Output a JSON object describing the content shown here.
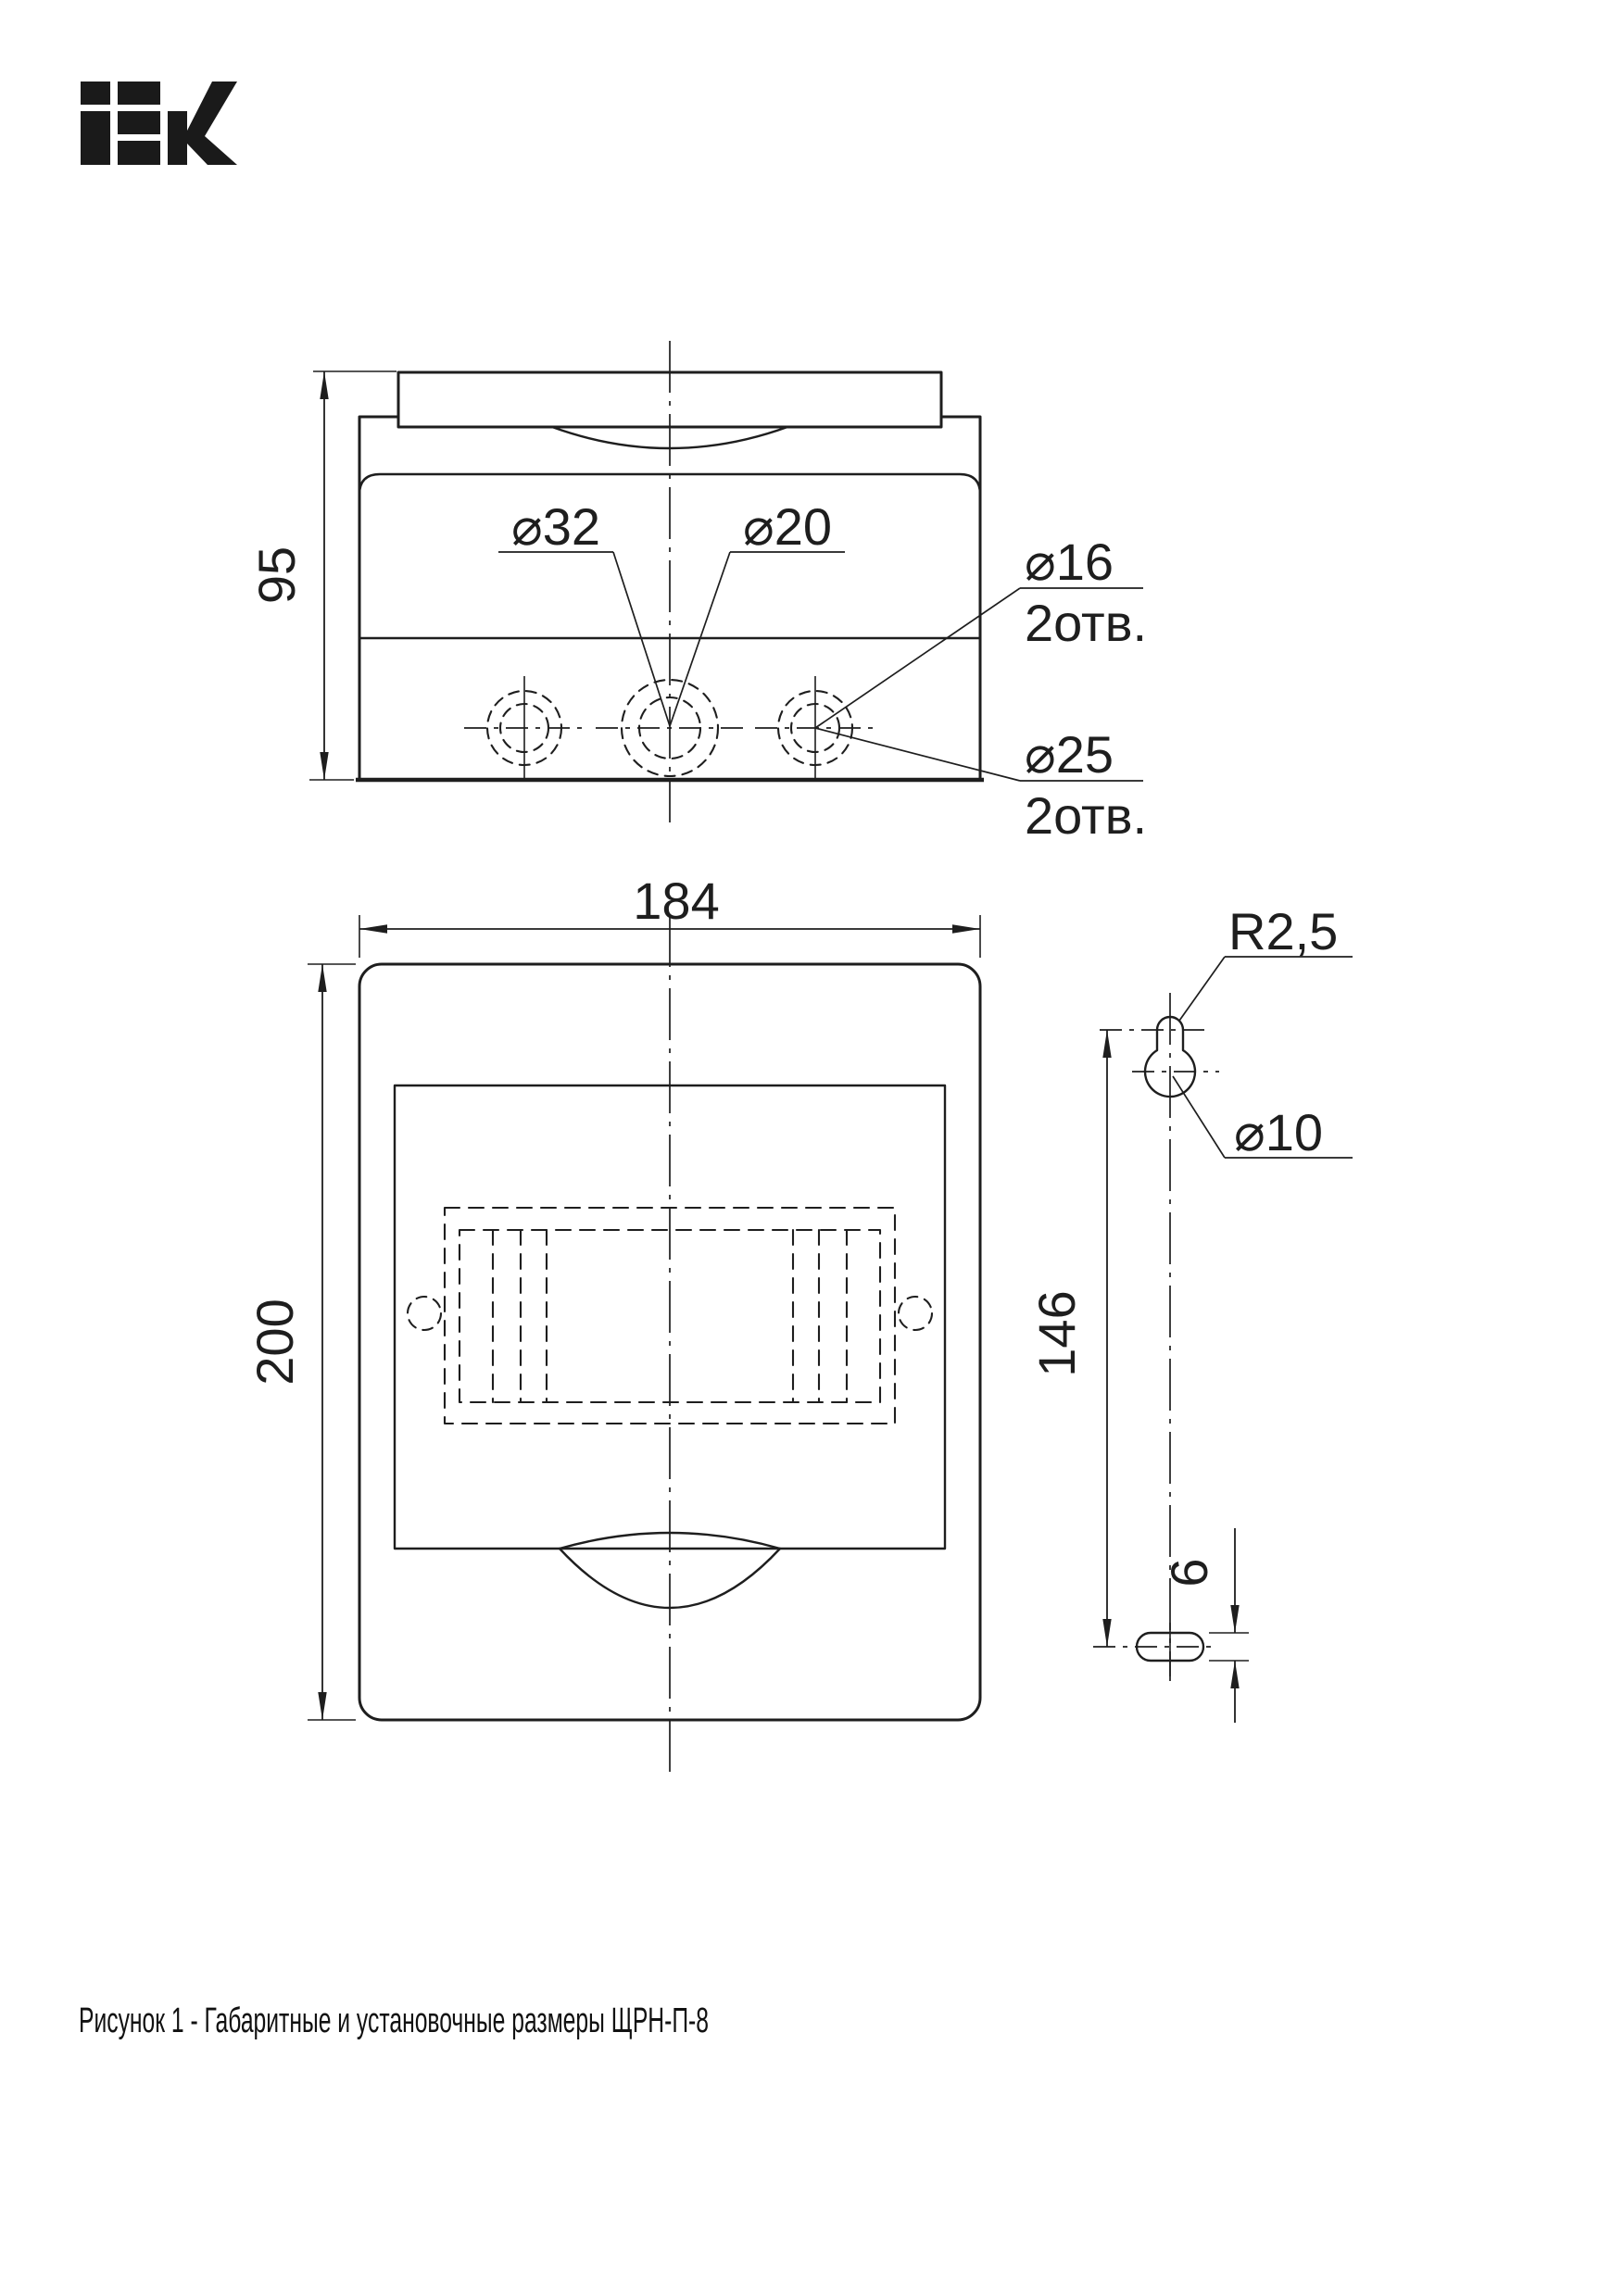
{
  "brand": "IEK",
  "caption": "Рисунок 1 - Габаритные и установочные размеры ЩРН-П-8",
  "top_view": {
    "depth": "95",
    "center_knockout_outer": "⌀32",
    "center_knockout_inner": "⌀20",
    "side_knockout_inner": "⌀16",
    "side_knockout_inner_qty": "2отв.",
    "side_knockout_outer": "⌀25",
    "side_knockout_outer_qty": "2отв."
  },
  "front_view": {
    "width": "184",
    "height": "200"
  },
  "mounting": {
    "keyhole_slot_radius": "R2,5",
    "keyhole_hole_diameter": "⌀10",
    "hole_to_slot_distance": "146",
    "slot_width": "6"
  },
  "colors": {
    "line": "#1e1e1e",
    "background": "#ffffff"
  }
}
